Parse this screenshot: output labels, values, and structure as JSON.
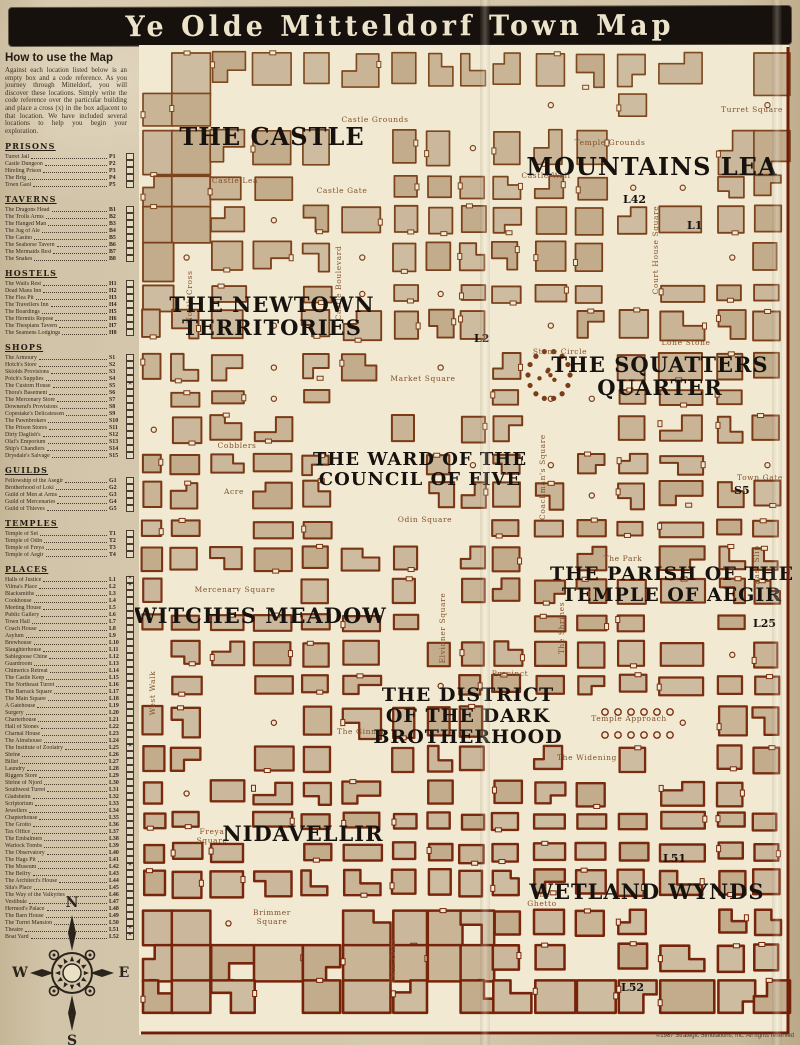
{
  "title": "Ye Olde Mitteldorf Town Map",
  "howto": {
    "heading": "How to use the Map",
    "body": "Against each location listed below is an empty box and a code reference. As you journey through Mitteldorf, you will discover these locations. Simply write the code reference over the particular building and place a cross (x) in the box adjacent to that location. We have included several locations to help you begin your exploration."
  },
  "palette": {
    "ink": "#17110d",
    "cream": "#f1e9d2",
    "building_fills": [
      "#c9b496",
      "#cdbca0",
      "#c2ac8c",
      "#cbb79b"
    ],
    "outline_north": "#7d4a1f",
    "outline_south": "#772109",
    "label_black": "#17120e",
    "street_brown": "#80512a",
    "border_red": "#6e1d08"
  },
  "legend_sections": [
    {
      "heading": "PRISONS",
      "entries": [
        {
          "name": "Turret Jail",
          "code": "P1",
          "checked": false
        },
        {
          "name": "Castle Dungeon",
          "code": "P2",
          "checked": false
        },
        {
          "name": "Hireling Prison",
          "code": "P3",
          "checked": false
        },
        {
          "name": "The Brig",
          "code": "P4",
          "checked": false
        },
        {
          "name": "Town Gaol",
          "code": "P5",
          "checked": false
        }
      ]
    },
    {
      "heading": "TAVERNS",
      "entries": [
        {
          "name": "The Dragons Head",
          "code": "B1",
          "checked": false
        },
        {
          "name": "The Trolls Arms",
          "code": "B2",
          "checked": false
        },
        {
          "name": "The Hanged Man",
          "code": "B3",
          "checked": false
        },
        {
          "name": "The Jug of Ale",
          "code": "B4",
          "checked": false
        },
        {
          "name": "The Casino",
          "code": "B5",
          "checked": false
        },
        {
          "name": "The Seahorse Tavern",
          "code": "B6",
          "checked": false
        },
        {
          "name": "The Mermaids Rest",
          "code": "B7",
          "checked": false
        },
        {
          "name": "The Snakes",
          "code": "B8",
          "checked": false
        }
      ]
    },
    {
      "heading": "HOSTELS",
      "entries": [
        {
          "name": "The Waifs Rest",
          "code": "H1",
          "checked": false
        },
        {
          "name": "Dead Mans Inn",
          "code": "H2",
          "checked": false
        },
        {
          "name": "The Flea Pit",
          "code": "H3",
          "checked": false
        },
        {
          "name": "The Travellers Inn",
          "code": "H4",
          "checked": false
        },
        {
          "name": "The Boardings",
          "code": "H5",
          "checked": false
        },
        {
          "name": "The Hermits Repose",
          "code": "H6",
          "checked": false
        },
        {
          "name": "The Thespians Tavern",
          "code": "H7",
          "checked": false
        },
        {
          "name": "The Seamens Lodgings",
          "code": "H8",
          "checked": false
        }
      ]
    },
    {
      "heading": "SHOPS",
      "entries": [
        {
          "name": "The Armoury",
          "code": "S1",
          "checked": false
        },
        {
          "name": "Hotch's Store",
          "code": "S2",
          "checked": false
        },
        {
          "name": "Skiolds Provisions",
          "code": "S3",
          "checked": false
        },
        {
          "name": "Potch's Supplies",
          "code": "S4",
          "checked": false
        },
        {
          "name": "The Custom House",
          "code": "S5",
          "checked": true
        },
        {
          "name": "Thora's Basement",
          "code": "S6",
          "checked": false
        },
        {
          "name": "The Mercenary Store",
          "code": "S7",
          "checked": false
        },
        {
          "name": "Downend's Provisions",
          "code": "S8",
          "checked": false
        },
        {
          "name": "Copestake's Delicatessen",
          "code": "S9",
          "checked": false
        },
        {
          "name": "The Pawnbrokers",
          "code": "S10",
          "checked": false
        },
        {
          "name": "The Prison Stores",
          "code": "S11",
          "checked": false
        },
        {
          "name": "Dirty Daglish's",
          "code": "S12",
          "checked": false
        },
        {
          "name": "Olaf's Emporium",
          "code": "S13",
          "checked": false
        },
        {
          "name": "Ship's Chandlers",
          "code": "S14",
          "checked": false
        },
        {
          "name": "Drysdale's Salvage",
          "code": "S15",
          "checked": false
        }
      ]
    },
    {
      "heading": "GUILDS",
      "entries": [
        {
          "name": "Fellowship of the Asegir",
          "code": "G1",
          "checked": false
        },
        {
          "name": "Brotherhood of Loki",
          "code": "G2",
          "checked": false
        },
        {
          "name": "Guild of Men at Arms",
          "code": "G3",
          "checked": false
        },
        {
          "name": "Guild of Mercenaries",
          "code": "G4",
          "checked": false
        },
        {
          "name": "Guild of Thieves",
          "code": "G5",
          "checked": false
        }
      ]
    },
    {
      "heading": "TEMPLES",
      "entries": [
        {
          "name": "Temple of Set",
          "code": "T1",
          "checked": false
        },
        {
          "name": "Temple of Odin",
          "code": "T2",
          "checked": false
        },
        {
          "name": "Temple of Freya",
          "code": "T3",
          "checked": false
        },
        {
          "name": "Temple of Aegir",
          "code": "T4",
          "checked": false
        }
      ]
    },
    {
      "heading": "PLACES",
      "entries": [
        {
          "name": "Halls of Justice",
          "code": "L1",
          "checked": true
        },
        {
          "name": "Vilma's Place",
          "code": "L2",
          "checked": true
        },
        {
          "name": "Blacksmiths",
          "code": "L3",
          "checked": false
        },
        {
          "name": "Cookhouse",
          "code": "L4",
          "checked": false
        },
        {
          "name": "Meeting House",
          "code": "L5",
          "checked": false
        },
        {
          "name": "Public Gallery",
          "code": "L6",
          "checked": false
        },
        {
          "name": "Town Hall",
          "code": "L7",
          "checked": false
        },
        {
          "name": "Coach House",
          "code": "L8",
          "checked": false
        },
        {
          "name": "Asylum",
          "code": "L9",
          "checked": false
        },
        {
          "name": "Brewhouse",
          "code": "L10",
          "checked": false
        },
        {
          "name": "Slaughterhouse",
          "code": "L11",
          "checked": false
        },
        {
          "name": "Sablegoose Chine",
          "code": "L12",
          "checked": false
        },
        {
          "name": "Guardroom",
          "code": "L13",
          "checked": false
        },
        {
          "name": "Chimerics Retreat",
          "code": "L14",
          "checked": false
        },
        {
          "name": "The Castle Keep",
          "code": "L15",
          "checked": false
        },
        {
          "name": "The Northeast Turret",
          "code": "L16",
          "checked": false
        },
        {
          "name": "The Barrack Square",
          "code": "L17",
          "checked": false
        },
        {
          "name": "The Main Square",
          "code": "L18",
          "checked": false
        },
        {
          "name": "A Gatehouse",
          "code": "L19",
          "checked": false
        },
        {
          "name": "Surgery",
          "code": "L20",
          "checked": false
        },
        {
          "name": "Charterhouse",
          "code": "L21",
          "checked": false
        },
        {
          "name": "Hall of Stones",
          "code": "L22",
          "checked": false
        },
        {
          "name": "Charnal House",
          "code": "L23",
          "checked": false
        },
        {
          "name": "The Almshouse",
          "code": "L24",
          "checked": false
        },
        {
          "name": "The Institute of Zoolatry",
          "code": "L25",
          "checked": true
        },
        {
          "name": "Shrine",
          "code": "L26",
          "checked": false
        },
        {
          "name": "Billet",
          "code": "L27",
          "checked": false
        },
        {
          "name": "Laundry",
          "code": "L28",
          "checked": false
        },
        {
          "name": "Riggers Store",
          "code": "L29",
          "checked": false
        },
        {
          "name": "Shrine of Njord",
          "code": "L30",
          "checked": false
        },
        {
          "name": "Southwest Turret",
          "code": "L31",
          "checked": false
        },
        {
          "name": "Gladsheim",
          "code": "L32",
          "checked": false
        },
        {
          "name": "Scriptorium",
          "code": "L33",
          "checked": false
        },
        {
          "name": "Jewellers",
          "code": "L34",
          "checked": false
        },
        {
          "name": "Chapterhouse",
          "code": "L35",
          "checked": false
        },
        {
          "name": "The Grotto",
          "code": "L36",
          "checked": false
        },
        {
          "name": "Tax Office",
          "code": "L37",
          "checked": false
        },
        {
          "name": "The Embalmers",
          "code": "L38",
          "checked": false
        },
        {
          "name": "Warlock Tombs",
          "code": "L39",
          "checked": false
        },
        {
          "name": "The Observatory",
          "code": "L40",
          "checked": false
        },
        {
          "name": "The Hags Pit",
          "code": "L41",
          "checked": false
        },
        {
          "name": "The Museum",
          "code": "L42",
          "checked": true
        },
        {
          "name": "The Belfry",
          "code": "L43",
          "checked": false
        },
        {
          "name": "The Architect's House",
          "code": "L44",
          "checked": false
        },
        {
          "name": "Sila's Place",
          "code": "L45",
          "checked": false
        },
        {
          "name": "The Way of the Valkyries",
          "code": "L46",
          "checked": false
        },
        {
          "name": "Vestibule",
          "code": "L47",
          "checked": false
        },
        {
          "name": "Hermod's Palace",
          "code": "L48",
          "checked": false
        },
        {
          "name": "The Barn House",
          "code": "L49",
          "checked": false
        },
        {
          "name": "The Turret Mansion",
          "code": "L50",
          "checked": false
        },
        {
          "name": "Theatre",
          "code": "L51",
          "checked": true
        },
        {
          "name": "Boat Yard",
          "code": "L52",
          "checked": true
        }
      ]
    }
  ],
  "map": {
    "districts": [
      {
        "id": "the-castle",
        "lines": [
          "THE CASTLE"
        ],
        "x": 137,
        "y": 100,
        "size": 24
      },
      {
        "id": "mountains-lea",
        "lines": [
          "MOUNTAINS LEA"
        ],
        "x": 517,
        "y": 130,
        "size": 24
      },
      {
        "id": "newtown-territories",
        "lines": [
          "THE NEWTOWN",
          "TERRITORIES"
        ],
        "x": 137,
        "y": 267,
        "size": 21
      },
      {
        "id": "squatters-quarter",
        "lines": [
          "THE SQUATTERS",
          "QUARTER"
        ],
        "x": 525,
        "y": 327,
        "size": 21
      },
      {
        "id": "ward-council-of-five",
        "lines": [
          "THE WARD OF THE",
          "COUNCIL OF FIVE"
        ],
        "x": 285,
        "y": 420,
        "size": 18
      },
      {
        "id": "parish-temple-aegir",
        "lines": [
          "THE PARISH OF THE",
          "TEMPLE OF AEGIR"
        ],
        "x": 537,
        "y": 535,
        "size": 19
      },
      {
        "id": "witches-meadow",
        "lines": [
          "WITCHES MEADOW"
        ],
        "x": 125,
        "y": 578,
        "size": 21
      },
      {
        "id": "district-dark-brotherhood",
        "lines": [
          "THE DISTRICT",
          "OF THE DARK",
          "BROTHERHOOD"
        ],
        "x": 333,
        "y": 656,
        "size": 19
      },
      {
        "id": "nidavellir",
        "lines": [
          "NIDAVELLIR"
        ],
        "x": 168,
        "y": 796,
        "size": 21
      },
      {
        "id": "wetland-wynds",
        "lines": [
          "WETLAND WYNDS"
        ],
        "x": 512,
        "y": 854,
        "size": 21
      }
    ],
    "streets": [
      {
        "label": "Castle Grounds",
        "x": 240,
        "y": 77,
        "vertical": false
      },
      {
        "label": "Castle Lea",
        "x": 100,
        "y": 138,
        "vertical": false
      },
      {
        "label": "Castle Gate",
        "x": 207,
        "y": 148,
        "vertical": false
      },
      {
        "label": "Castle Wall",
        "x": 411,
        "y": 133,
        "vertical": false
      },
      {
        "label": "Temple Grounds",
        "x": 475,
        "y": 100,
        "vertical": false
      },
      {
        "label": "Turret Square",
        "x": 617,
        "y": 67,
        "vertical": false
      },
      {
        "label": "Court House Square",
        "x": 523,
        "y": 205,
        "vertical": true
      },
      {
        "label": "North Cross",
        "x": 57,
        "y": 252,
        "vertical": true
      },
      {
        "label": "Castle Boulevard",
        "x": 206,
        "y": 238,
        "vertical": true
      },
      {
        "label": "Market Square",
        "x": 288,
        "y": 336,
        "vertical": false
      },
      {
        "label": "Lone Stone",
        "x": 551,
        "y": 300,
        "vertical": false
      },
      {
        "label": "Stone Circle",
        "x": 425,
        "y": 309,
        "vertical": false
      },
      {
        "label": "Cobblers",
        "x": 102,
        "y": 403,
        "vertical": false
      },
      {
        "label": "Acre",
        "x": 99,
        "y": 449,
        "vertical": false
      },
      {
        "label": "Odin Square",
        "x": 290,
        "y": 477,
        "vertical": false
      },
      {
        "label": "Coachman's Square",
        "x": 410,
        "y": 432,
        "vertical": true
      },
      {
        "label": "Town Gate",
        "x": 625,
        "y": 435,
        "vertical": false
      },
      {
        "label": "East Slip",
        "x": 624,
        "y": 520,
        "vertical": true
      },
      {
        "label": "The Park",
        "x": 488,
        "y": 516,
        "vertical": false
      },
      {
        "label": "The Shrines",
        "x": 429,
        "y": 583,
        "vertical": true
      },
      {
        "label": "Mercenary Square",
        "x": 100,
        "y": 547,
        "vertical": false
      },
      {
        "label": "West Walk",
        "x": 20,
        "y": 648,
        "vertical": true
      },
      {
        "label": "Elvidner Square",
        "x": 310,
        "y": 583,
        "vertical": true
      },
      {
        "label": "Precinct",
        "x": 375,
        "y": 631,
        "vertical": false
      },
      {
        "label": "The Ginnels",
        "x": 228,
        "y": 689,
        "vertical": false
      },
      {
        "label": "Temple Approach",
        "x": 494,
        "y": 676,
        "vertical": false
      },
      {
        "label": "The Widening",
        "x": 452,
        "y": 715,
        "vertical": false
      },
      {
        "label": "Freya Square",
        "x": 77,
        "y": 789,
        "vertical": false,
        "wrap": true
      },
      {
        "label": "Brimmer Square",
        "x": 137,
        "y": 870,
        "vertical": false,
        "wrap": true
      },
      {
        "label": "Twin Oaks",
        "x": 260,
        "y": 916,
        "vertical": true
      },
      {
        "label": "The Ghetto",
        "x": 407,
        "y": 852,
        "vertical": false,
        "wrap": true
      }
    ],
    "annotations": [
      {
        "label": "L42",
        "x": 488,
        "y": 158
      },
      {
        "label": "L1",
        "x": 552,
        "y": 184
      },
      {
        "label": "L2",
        "x": 339,
        "y": 297
      },
      {
        "label": "S5",
        "x": 599,
        "y": 449
      },
      {
        "label": "L25",
        "x": 618,
        "y": 582
      },
      {
        "label": "L51",
        "x": 528,
        "y": 817
      },
      {
        "label": "L52",
        "x": 486,
        "y": 946
      }
    ]
  },
  "compass": {
    "north": "N",
    "east": "E",
    "south": "S",
    "west": "W"
  },
  "footer": {
    "copyright": "©1987 Strategic Simulations, Inc. All rights reserved"
  }
}
